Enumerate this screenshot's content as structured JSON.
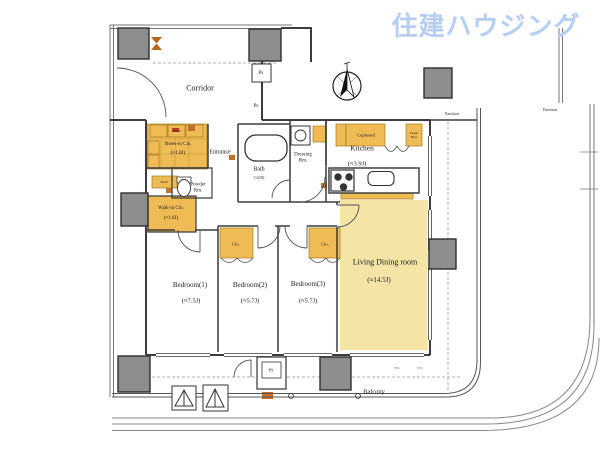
{
  "brand": {
    "watermark": "住建ハウジング"
  },
  "colors": {
    "watermark_blue": "#b7cdf1",
    "closet_yellow": "#eebb55",
    "living_yellow": "#f4e4a6",
    "pillar_gray": "#8d8d8d",
    "accent_orange": "#c2702a"
  },
  "rooms": {
    "corridor": {
      "name": "Corridor"
    },
    "entrance": {
      "name": "Entrance"
    },
    "shoes_in_closet": {
      "name": "Shoes-in Clo.",
      "area": "(≈1.0J)"
    },
    "powder_room": {
      "name": "Powder Rm."
    },
    "walk_in_closet": {
      "name": "Walk-in Clo.",
      "area": "(≈1.6J)"
    },
    "bath": {
      "name": "Bath",
      "area": "(1418)"
    },
    "dressing_room": {
      "name": "Dressing Rm."
    },
    "kitchen": {
      "name": "Kitchen",
      "area": "(≈3.9J)"
    },
    "living_dining": {
      "name": "Living Dining room",
      "area": "(≈14.5J)"
    },
    "bedroom1": {
      "name": "Bedroom(1)",
      "area": "(≈7.5J)"
    },
    "bedroom2": {
      "name": "Bedroom(2)",
      "area": "(≈5.7J)"
    },
    "bedroom3": {
      "name": "Bedroom(3)",
      "area": "(≈5.7J)"
    },
    "balcony": {
      "name": "Balcony"
    }
  },
  "fixtures": {
    "cupboard": "Cupboard",
    "clean_box": "Clean Box",
    "closet2": "Clo.",
    "closet3": "Clo.",
    "shelf_top": "Shelf",
    "shelf_side": "Shelf",
    "ps_alcove": "Ps",
    "ps_wall": "Ps",
    "ps_balcony": "PS",
    "partition_north": "Partition",
    "partition_east": "Partition",
    "fix_window1": "FIX",
    "fix_window2": "FIX"
  }
}
